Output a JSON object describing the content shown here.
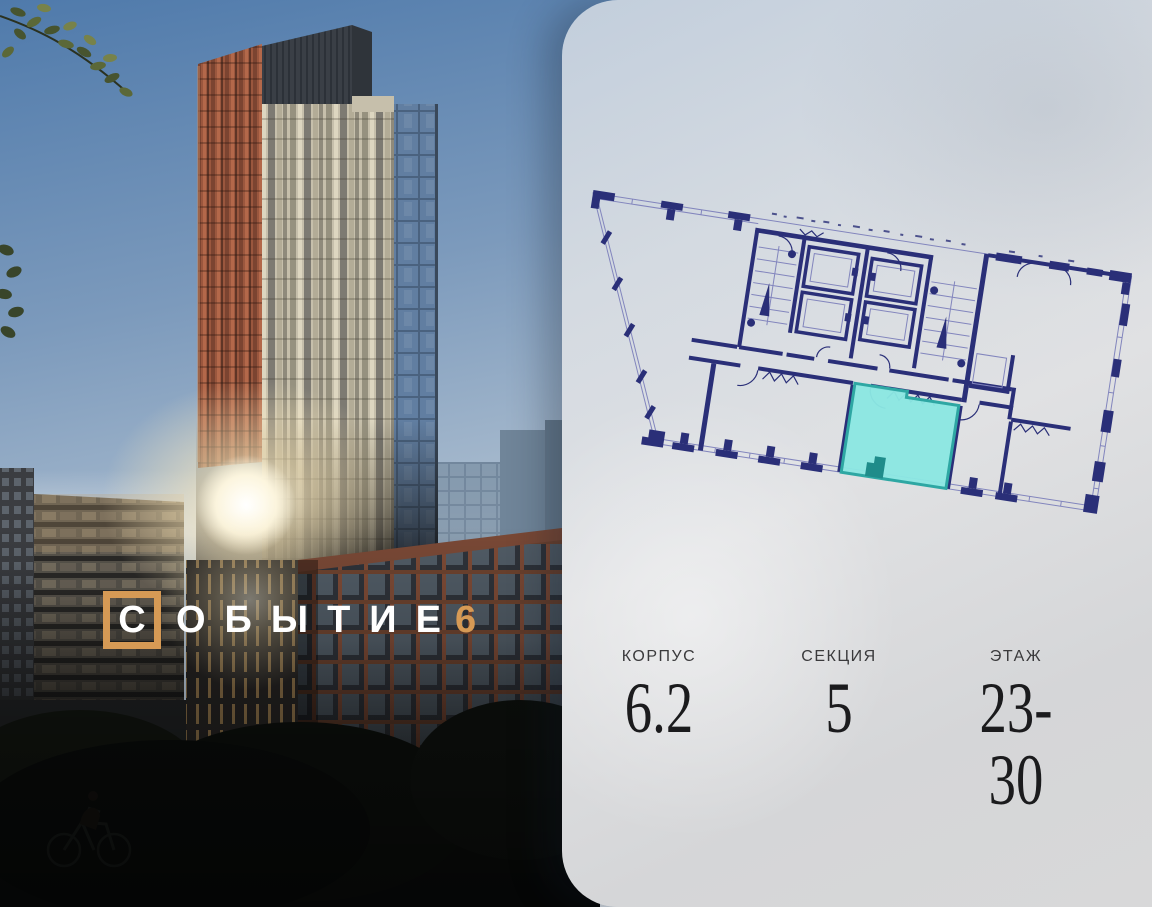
{
  "brand": {
    "letter_in_frame": "С",
    "wordmark_rest": "ОБЫТИЕ",
    "number": "6"
  },
  "info": {
    "items": [
      {
        "label": "КОРПУС",
        "value": "6.2"
      },
      {
        "label": "СЕКЦИЯ",
        "value": "5"
      },
      {
        "label": "ЭТАЖ",
        "value": "23-30"
      }
    ]
  },
  "floor_plan": {
    "selected_unit_highlighted": true,
    "orientation_degrees": 8.8
  },
  "colors": {
    "accent": "#D69A55",
    "plan-wall": "#2A2F78",
    "plan-line": "#8285BD",
    "unit-fill": "#8BE7E2",
    "unit-stroke": "#2EA7A3",
    "unit-notch": "#1F8C8A",
    "card-top": "#C2CEDC",
    "card-bottom": "#D8D8D9",
    "info-label": "#3A3A3C",
    "info-value": "#1B1B1D",
    "sky-top": "#4F7AAB"
  }
}
